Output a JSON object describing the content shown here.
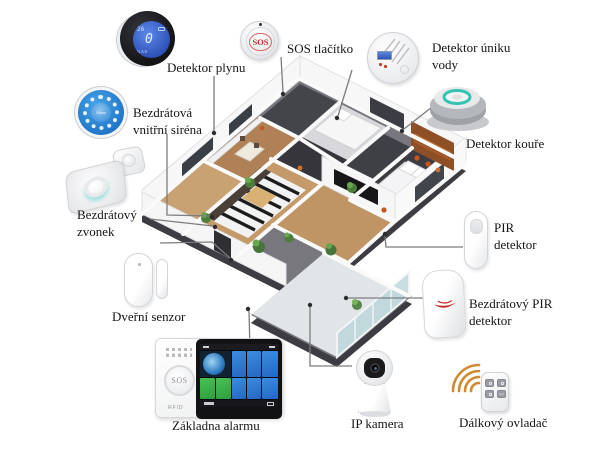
{
  "diagram": {
    "type": "smart-home-alarm-system-overview",
    "language": "cs",
    "labels": {
      "gas": "Detektor plynu",
      "sos": "SOS tlačítko",
      "water": [
        "Detektor úniku",
        "vody"
      ],
      "smoke": "Detektor kouře",
      "siren": [
        "Bezdrátová",
        "vnitřní siréna"
      ],
      "doorbell": [
        "Bezdrátový",
        "zvonek"
      ],
      "door_sensor": "Dveřní senzor",
      "pir": [
        "PIR",
        "detektor"
      ],
      "wireless_pir": [
        "Bezdrátový PIR",
        "detektor"
      ],
      "alarm_panel": "Základna alarmu",
      "ip_camera": "IP kamera",
      "remote": "Dálkový ovladač"
    },
    "devices": {
      "gas_detector": {
        "lcd_temp": "26",
        "lcd_value": "0",
        "lcd_unit": "GAS"
      },
      "sos_button": {
        "text": "SOS"
      },
      "indoor_siren": {
        "text": "Siren"
      },
      "alarm_panel": {
        "sos_text": "SOS",
        "rfid_text": "RFID"
      },
      "remote_control": {
        "sos_button_text": "sos"
      }
    },
    "colors": {
      "lcd_blue": "#3a63c8",
      "siren_blue": "#2286d8",
      "smoke_ring_teal": "#35c2b2",
      "alert_red": "#c62a28",
      "rf_wave_orange": "#cf8a33",
      "screen_tile_blue": "#2f7fd6",
      "screen_tile_green": "#3db54a"
    }
  }
}
